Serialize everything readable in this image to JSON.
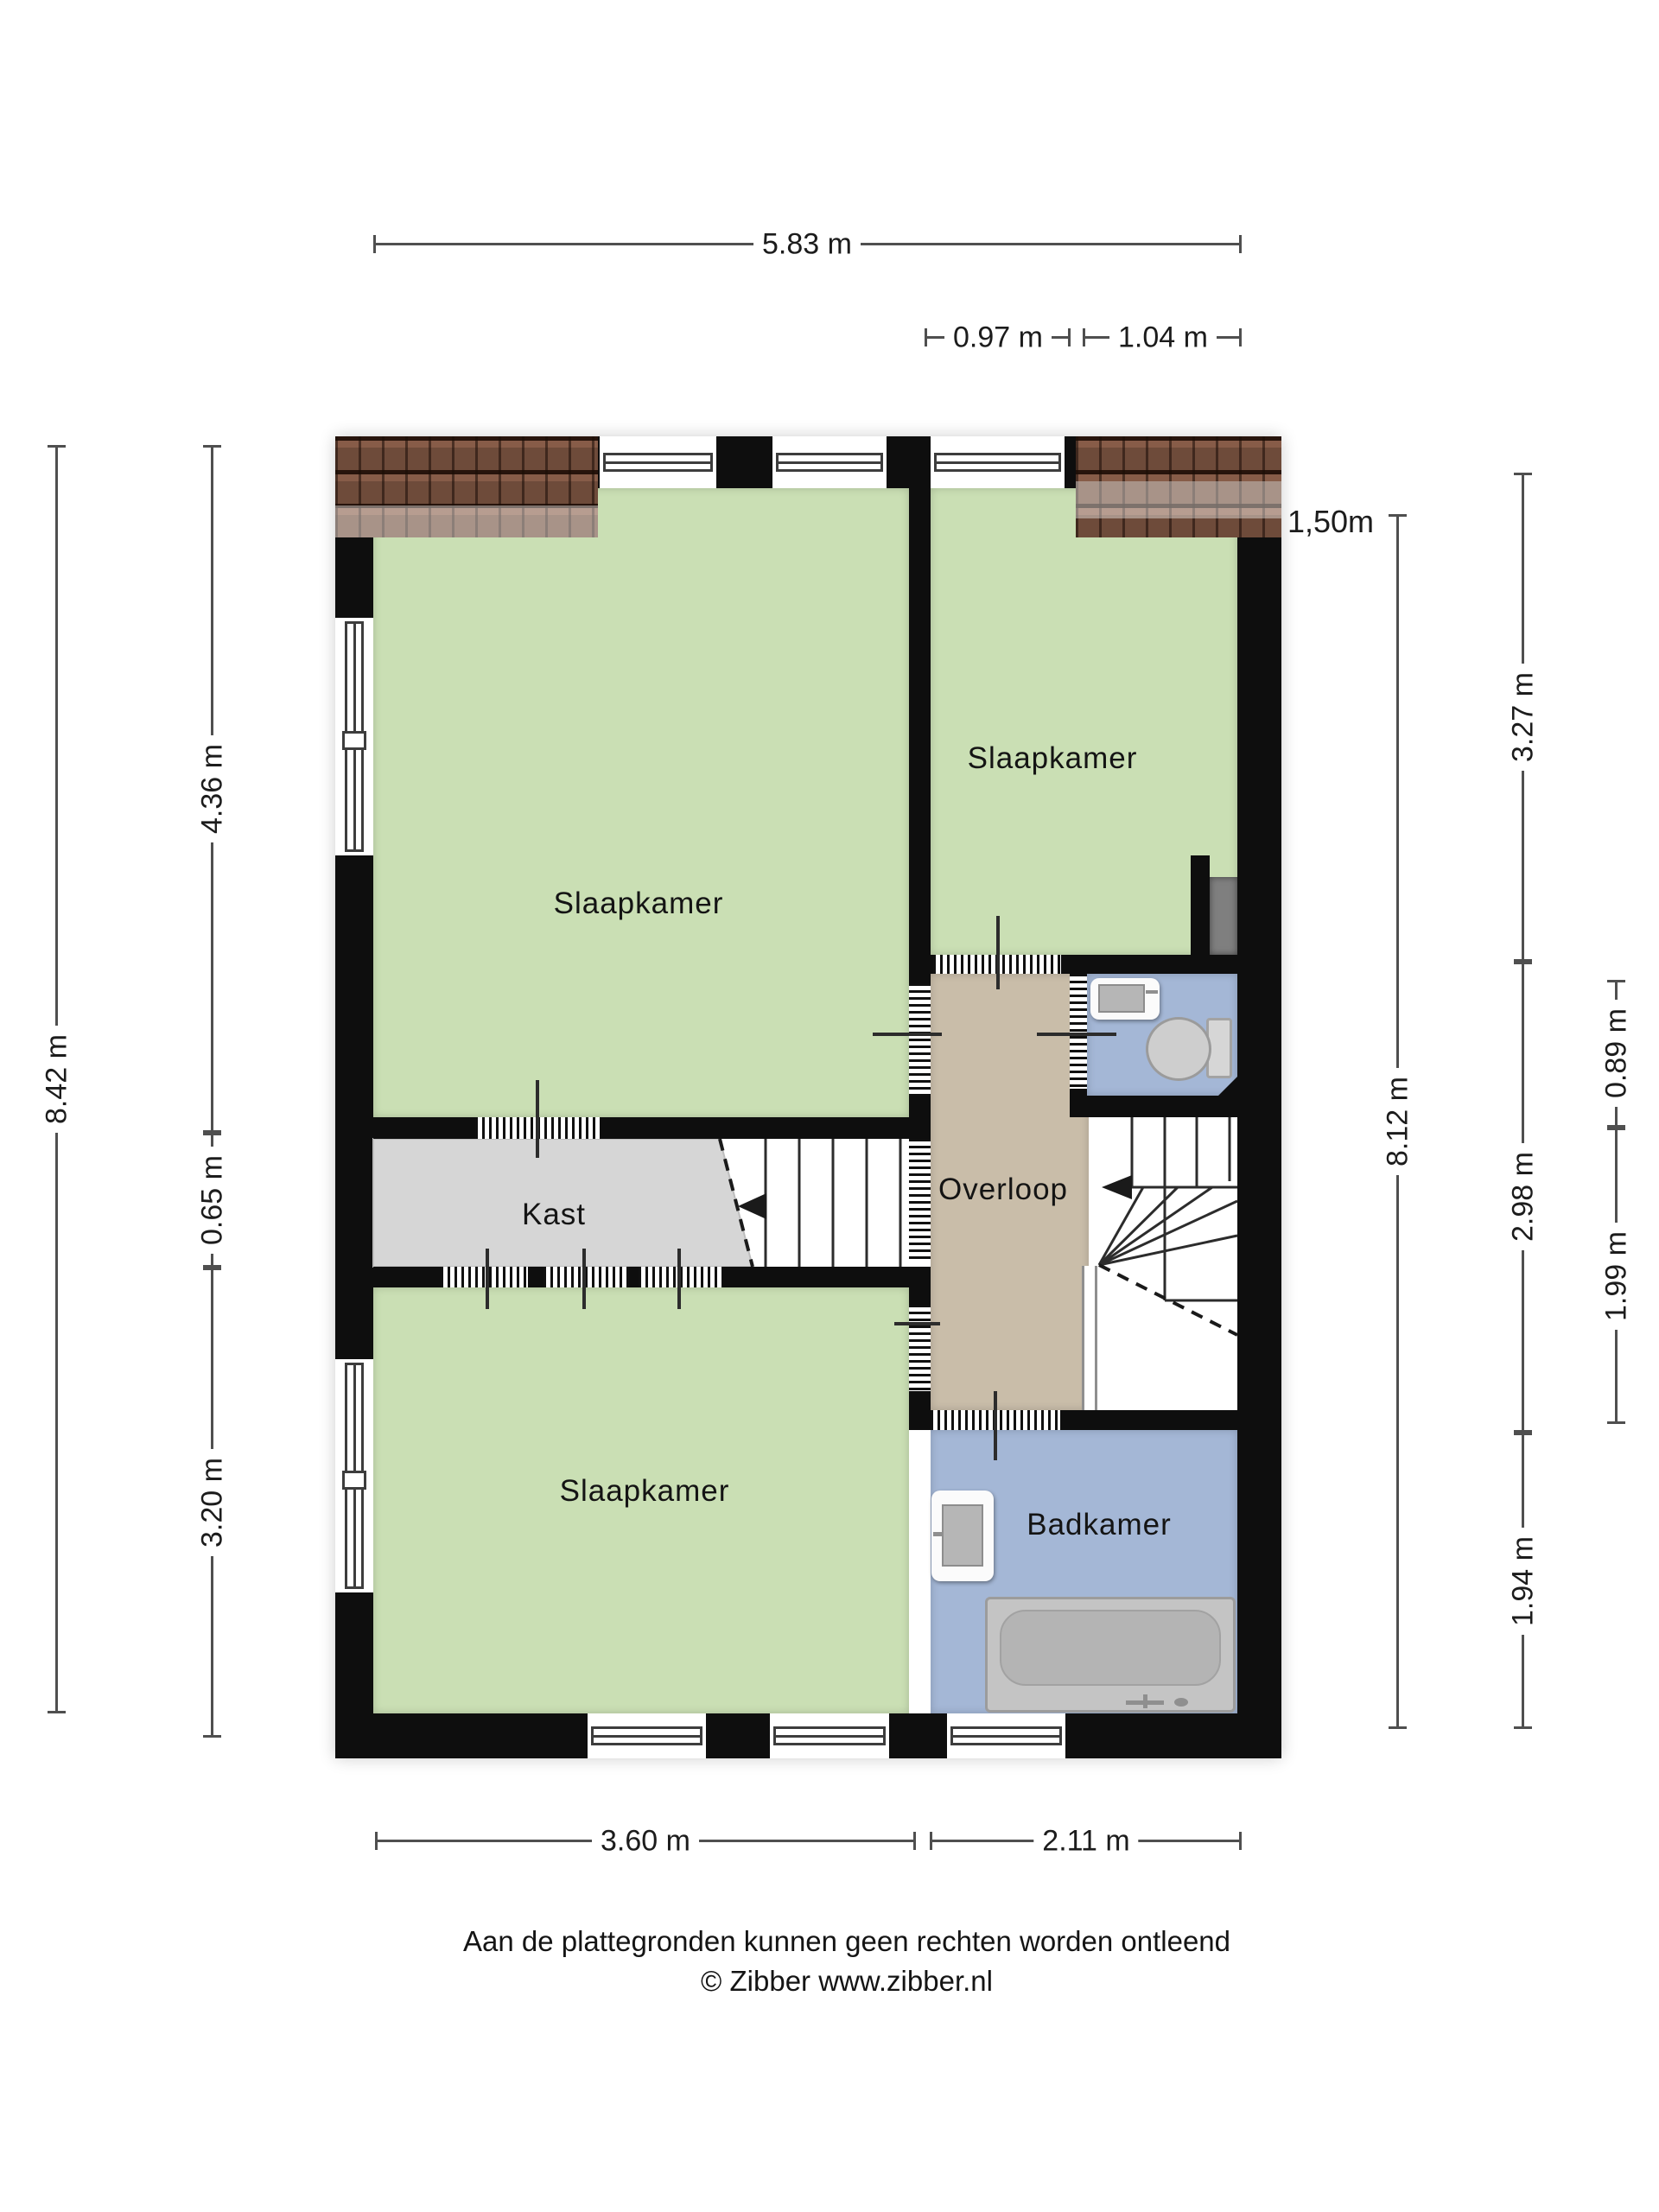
{
  "rooms": {
    "bedroom_top_left": {
      "label": "Slaapkamer"
    },
    "bedroom_top_right": {
      "label": "Slaapkamer"
    },
    "bedroom_bottom": {
      "label": "Slaapkamer"
    },
    "closet": {
      "label": "Kast"
    },
    "landing": {
      "label": "Overloop"
    },
    "bathroom": {
      "label": "Badkamer"
    }
  },
  "dimensions": {
    "top_total": "5.83 m",
    "top_door": "0.97 m",
    "top_toilet": "1.04 m",
    "left_total": "8.42 m",
    "left_upper": "4.36 m",
    "left_closet": "0.65 m",
    "left_lower": "3.20 m",
    "right_total": "8.12 m",
    "right_upper": "3.27 m",
    "right_middle": "2.98 m",
    "right_lower": "1.94 m",
    "right_inner_upper": "0.89 m",
    "right_inner_lower": "1.99 m",
    "knee_wall_height": "1,50m",
    "bottom_left": "3.60 m",
    "bottom_right": "2.11 m"
  },
  "footer": {
    "disclaimer": "Aan de plattegronden kunnen geen rechten worden ontleend",
    "copyright": "© Zibber www.zibber.nl"
  },
  "colors": {
    "wall": "#0e0e0e",
    "floor_green": "#cadfb4",
    "floor_blue": "#a4b7d6",
    "landing_beige": "#c9bda9",
    "closet_gray": "#d6d6d6",
    "roof_brown": "#6e4b3a",
    "dimension_line": "#4f4f4f"
  }
}
